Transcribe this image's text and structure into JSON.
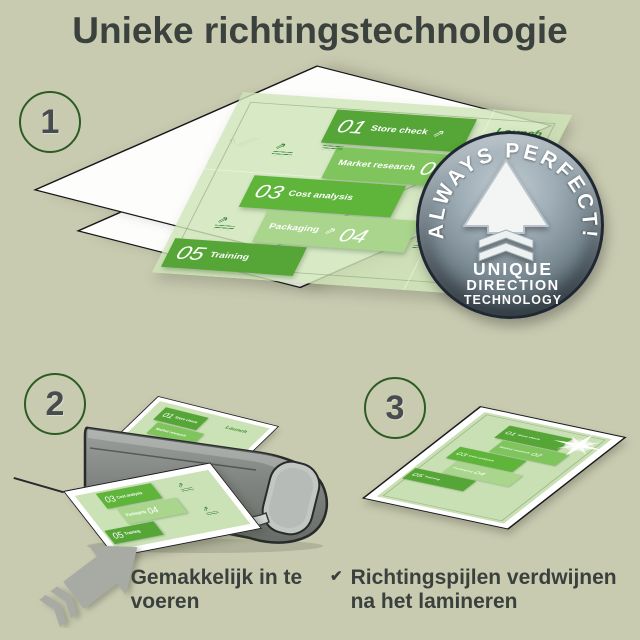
{
  "title": "Unieke richtingstechnologie",
  "step1": {
    "number": "1"
  },
  "step2": {
    "number": "2"
  },
  "step3": {
    "number": "3"
  },
  "infographic": {
    "launch_label": "Launch",
    "items": [
      {
        "num": "01",
        "label": "Store check"
      },
      {
        "num": "02",
        "label": "Market research"
      },
      {
        "num": "03",
        "label": "Cost analysis"
      },
      {
        "num": "04",
        "label": "Packaging"
      },
      {
        "num": "05",
        "label": "Training"
      }
    ]
  },
  "badge": {
    "arc_text": "ALWAYS PERFECT!",
    "line1": "UNIQUE",
    "line2": "DIRECTION",
    "line3": "TECHNOLOGY"
  },
  "checklist": {
    "items": [
      "Gemakkelijk in te voeren",
      "Richtingspijlen verdwijnen na het lamineren"
    ]
  },
  "icons": {
    "checkmark": "✔",
    "direction_arrow": "⇗"
  },
  "colors": {
    "background": "#c9cbb1",
    "text_dark": "#3b423e",
    "circle_outline": "#2d5b25",
    "green_dark": "#55a636",
    "green_mid": "#7fc45c",
    "green_bright": "#5eb53a",
    "green_light": "#a9d58c",
    "green_pale": "#cfe3ba",
    "badge_face": "#76868f",
    "laminator_gray": "#7e837f"
  }
}
